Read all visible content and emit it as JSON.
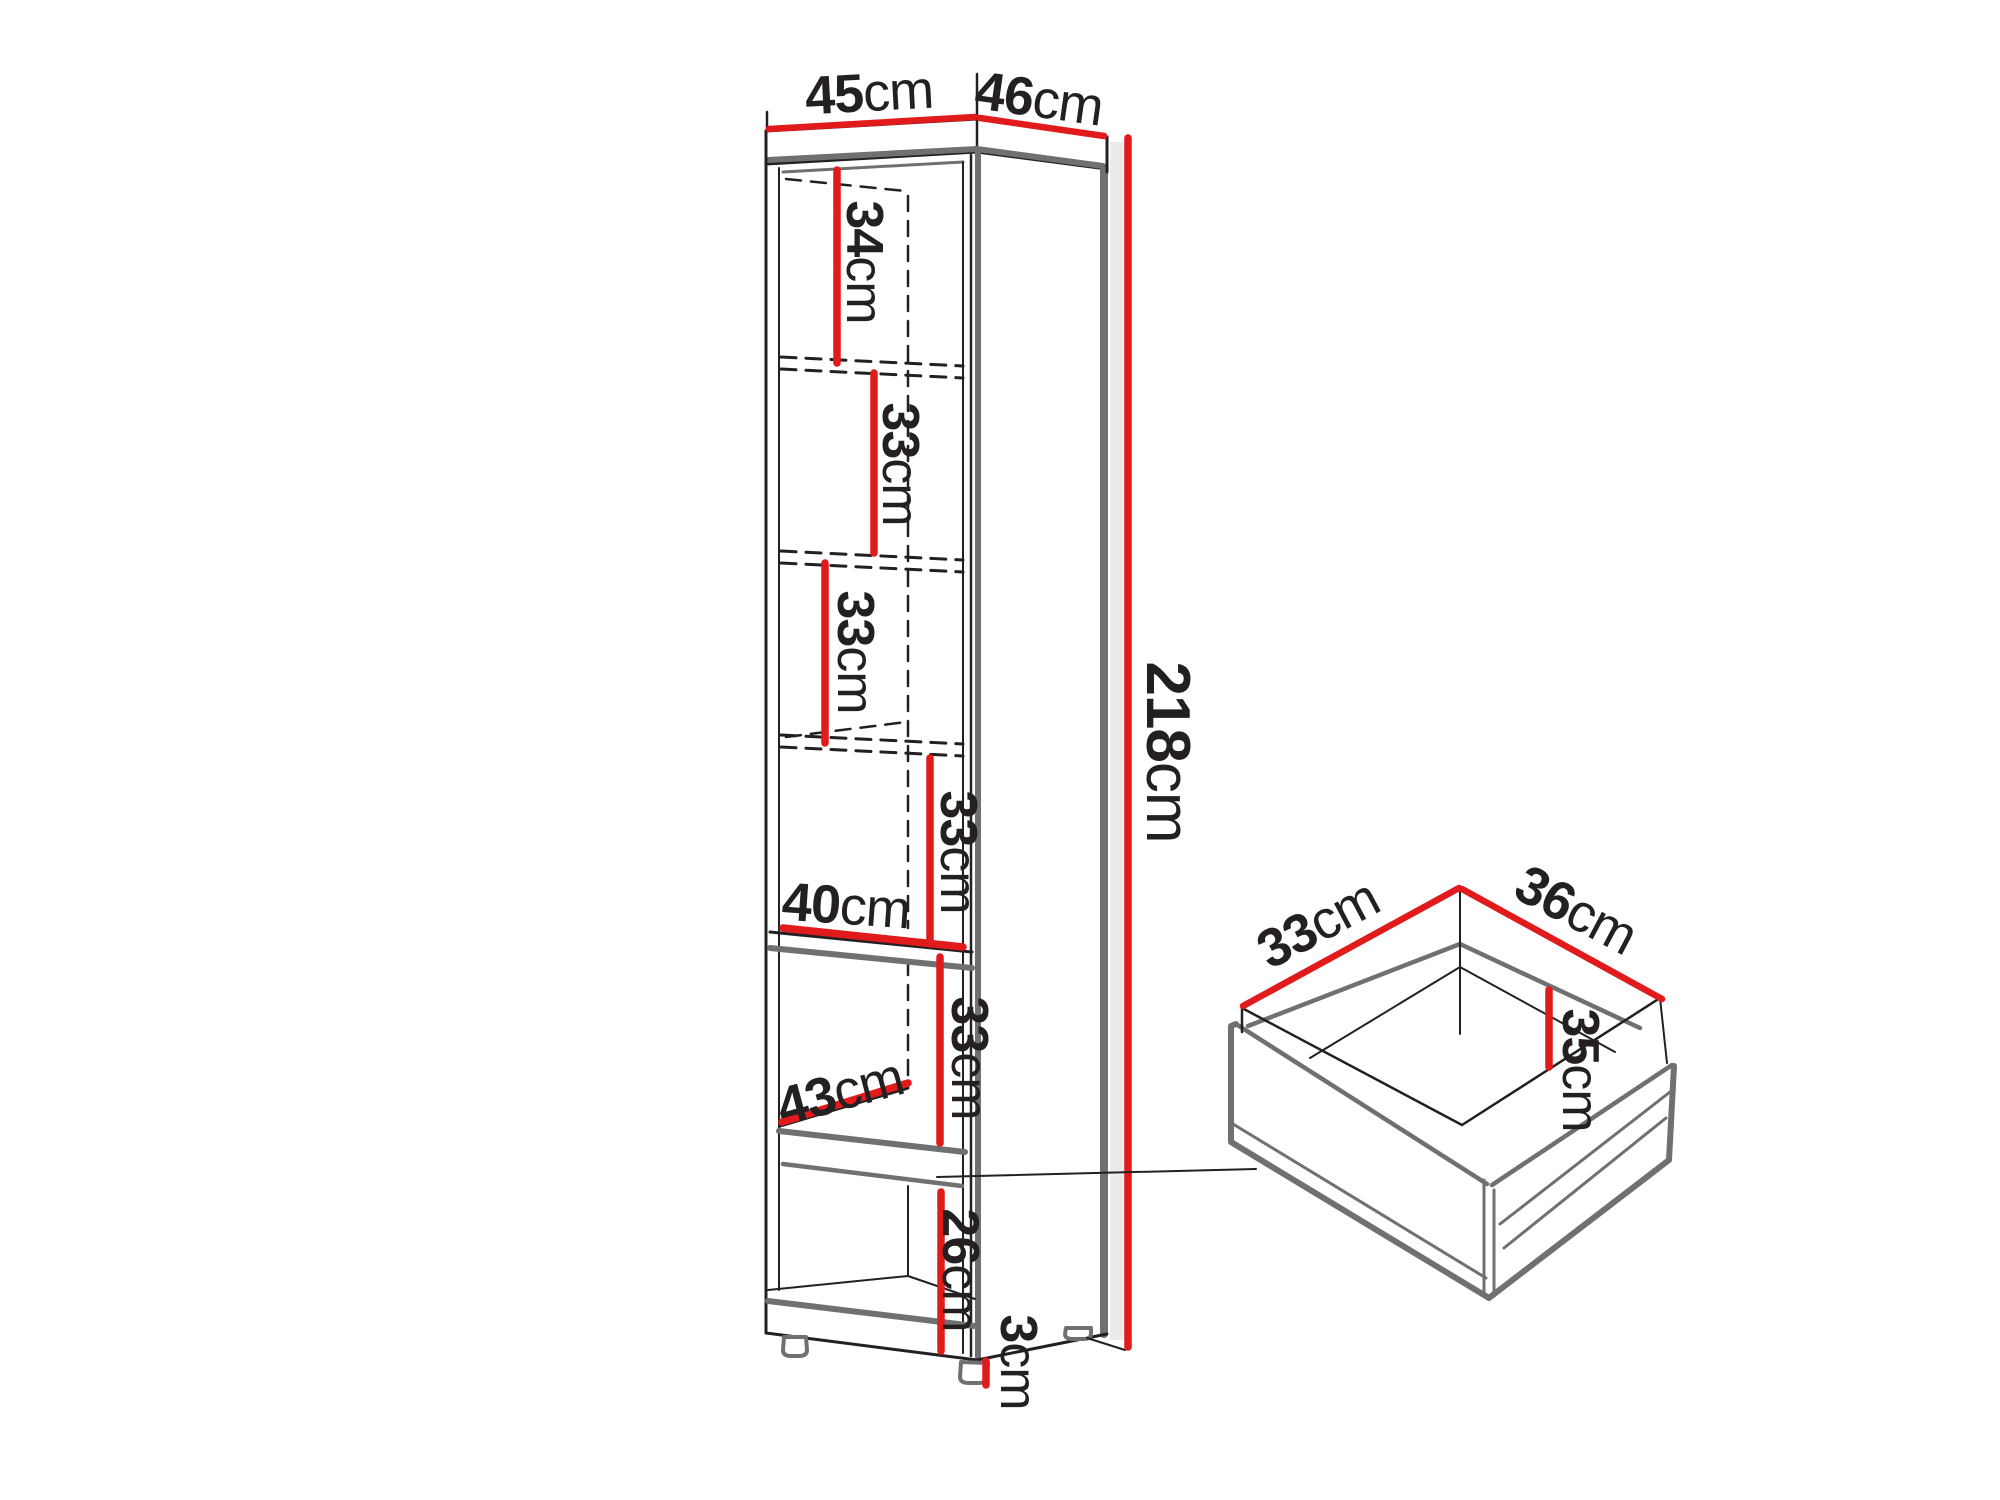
{
  "colors": {
    "dimension_red": "#e11b1c",
    "line_black": "#242021",
    "panel_gray": "#6e7072",
    "shadow_gray": "#ebebeb"
  },
  "labels": {
    "top_width": {
      "value": "45",
      "unit": "cm"
    },
    "top_depth": {
      "value": "46",
      "unit": "cm"
    },
    "section_1": {
      "value": "34",
      "unit": "cm"
    },
    "section_2": {
      "value": "33",
      "unit": "cm"
    },
    "section_3": {
      "value": "33",
      "unit": "cm"
    },
    "section_4": {
      "value": "33",
      "unit": "cm"
    },
    "shelf_width": {
      "value": "40",
      "unit": "cm"
    },
    "section_5": {
      "value": "33",
      "unit": "cm"
    },
    "shelf_depth": {
      "value": "43",
      "unit": "cm"
    },
    "section_6": {
      "value": "26",
      "unit": "cm"
    },
    "feet_height": {
      "value": "3",
      "unit": "cm"
    },
    "total_height": {
      "value": "218",
      "unit": "cm"
    },
    "drawer_width": {
      "value": "33",
      "unit": "cm"
    },
    "drawer_depth": {
      "value": "36",
      "unit": "cm"
    },
    "drawer_height": {
      "value": "35",
      "unit": "cm"
    }
  }
}
